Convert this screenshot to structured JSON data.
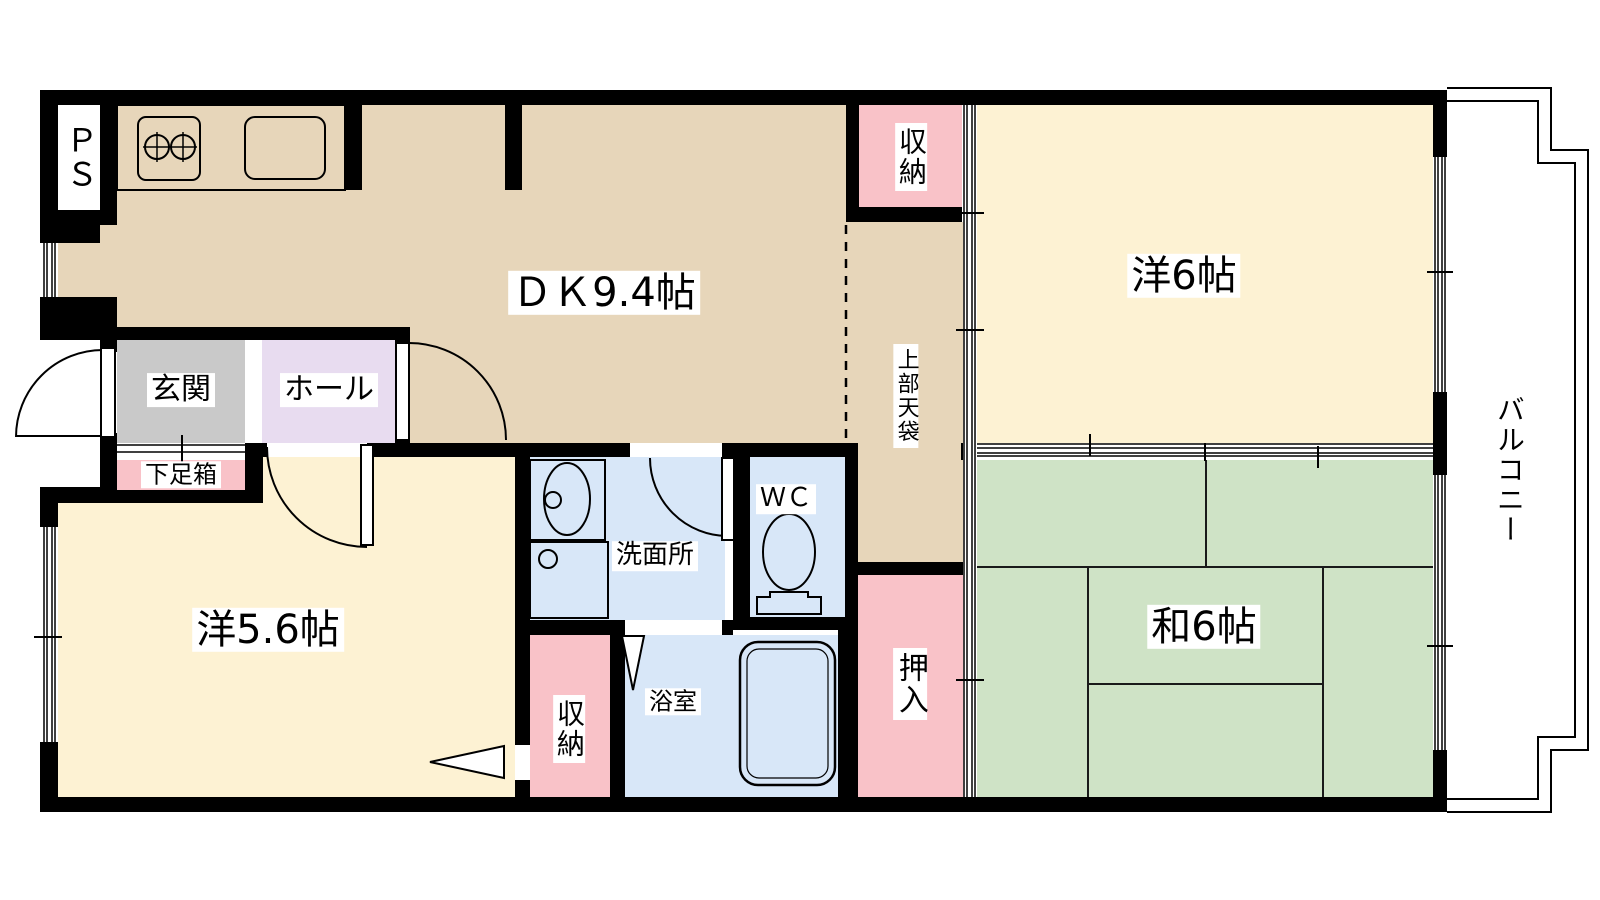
{
  "rooms": {
    "ps": {
      "label": "ＰＳ"
    },
    "dk": {
      "label": "ＤＫ9.4帖"
    },
    "storage_top": {
      "label": "収納"
    },
    "upper_tenbukuro": {
      "label": "上部天袋"
    },
    "western_6": {
      "label": "洋6帖"
    },
    "balcony": {
      "label": "バルコニー"
    },
    "entrance": {
      "label": "玄関"
    },
    "hall": {
      "label": "ホール"
    },
    "shoe_box": {
      "label": "下足箱"
    },
    "western_5_6": {
      "label": "洋5.6帖"
    },
    "washroom": {
      "label": "洗面所"
    },
    "wc": {
      "label": "ＷＣ"
    },
    "storage_bottom": {
      "label": "収納"
    },
    "bathroom": {
      "label": "浴室"
    },
    "oshiire": {
      "label": "押入"
    },
    "japanese_6": {
      "label": "和6帖"
    }
  },
  "colors": {
    "wall": "#000000",
    "dk_floor": "#e7d6ba",
    "western_floor": "#fdf2d3",
    "tatami_green": "#cfe3c6",
    "closet_pink": "#f9c2c8",
    "hall_lavender": "#e8dcf0",
    "entrance_gray": "#c9c9c9",
    "water_blue": "#d8e7f8",
    "balcony_white": "#ffffff"
  }
}
